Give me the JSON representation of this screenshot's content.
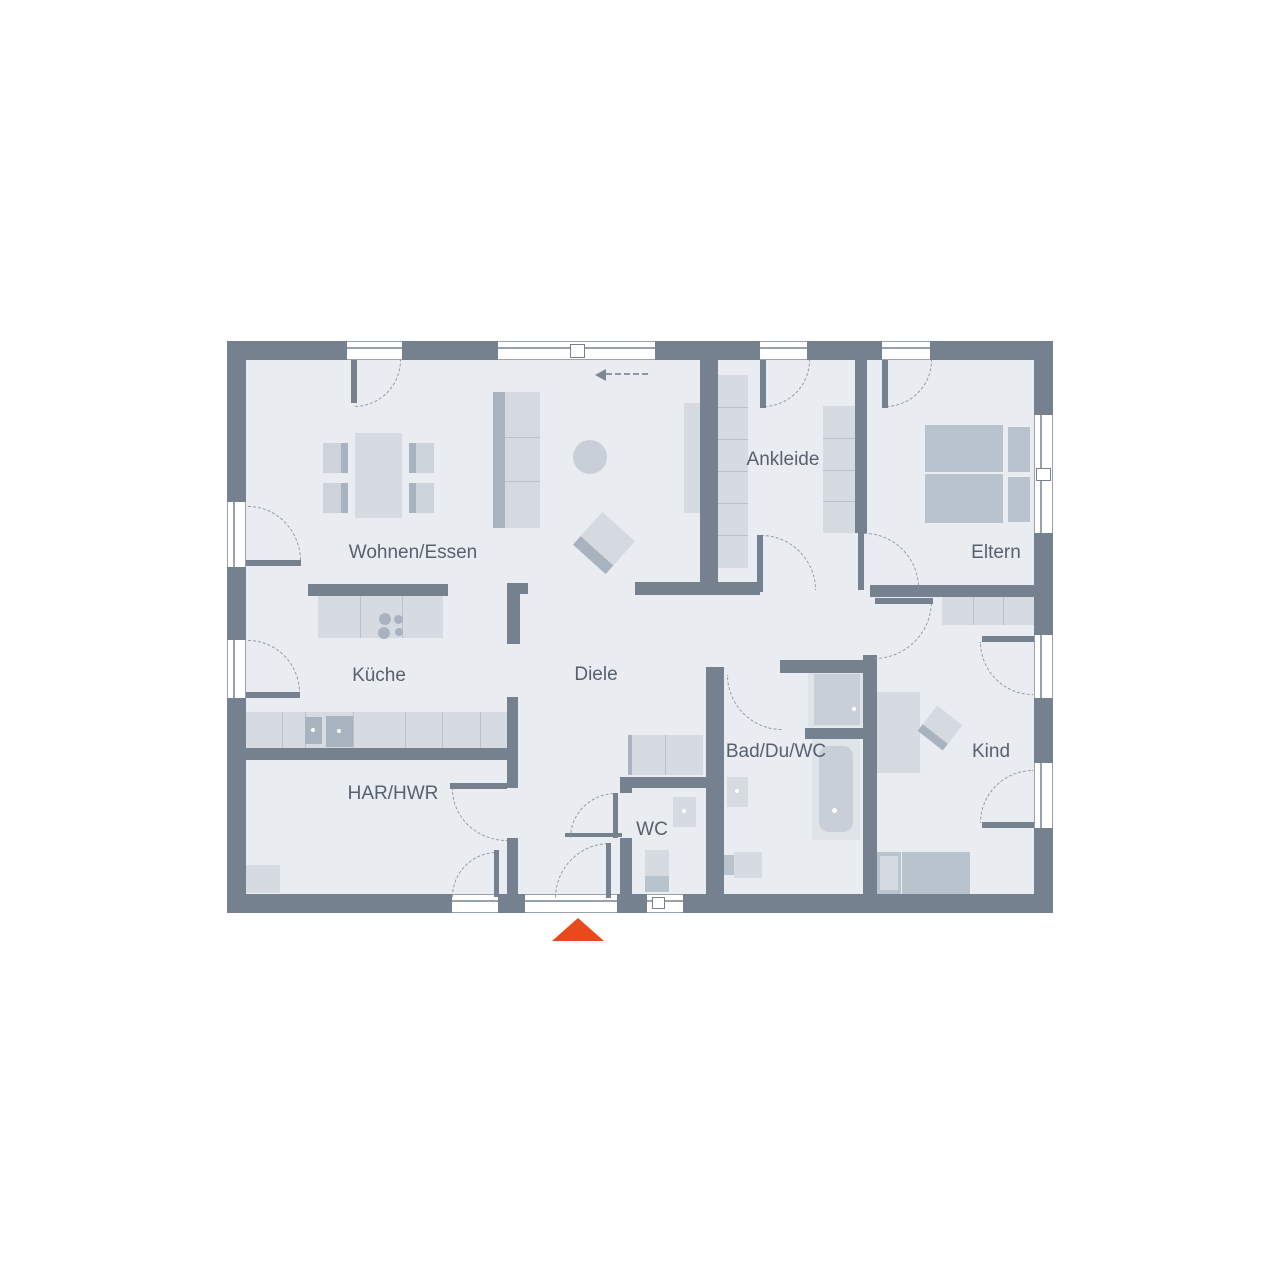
{
  "palette": {
    "wall": "#76818f",
    "floor": "#e9edf1",
    "furniture_light": "#d6dbe2",
    "furniture_mid": "#b9c3cd",
    "dash": "#8f99a5",
    "entry_marker_red": "#e8491d",
    "label_text": "#57616e"
  },
  "floorplan": {
    "floor": [
      246,
      360,
      788,
      534
    ],
    "labels": [
      {
        "t": "Wohnen/Essen",
        "x": 413,
        "y": 553
      },
      {
        "t": "Küche",
        "x": 379,
        "y": 676
      },
      {
        "t": "Diele",
        "x": 596,
        "y": 675
      },
      {
        "t": "HAR/HWR",
        "x": 393,
        "y": 794
      },
      {
        "t": "WC",
        "x": 652,
        "y": 830
      },
      {
        "t": "Bad/Du/WC",
        "x": 776,
        "y": 752
      },
      {
        "t": "Ankleide",
        "x": 783,
        "y": 460
      },
      {
        "t": "Eltern",
        "x": 996,
        "y": 553
      },
      {
        "t": "Kind",
        "x": 991,
        "y": 752
      }
    ],
    "walls": [
      [
        227,
        341,
        120,
        19
      ],
      [
        402,
        341,
        96,
        19
      ],
      [
        655,
        341,
        105,
        19
      ],
      [
        807,
        341,
        75,
        19
      ],
      [
        930,
        341,
        123,
        19
      ],
      [
        227,
        894,
        225,
        19
      ],
      [
        498,
        894,
        27,
        19
      ],
      [
        617,
        894,
        30,
        19
      ],
      [
        683,
        894,
        370,
        19
      ],
      [
        227,
        341,
        19,
        161
      ],
      [
        227,
        567,
        19,
        73
      ],
      [
        227,
        698,
        19,
        215
      ],
      [
        1034,
        341,
        19,
        74
      ],
      [
        1034,
        533,
        19,
        102
      ],
      [
        1034,
        698,
        19,
        65
      ],
      [
        1034,
        828,
        19,
        85
      ],
      [
        700,
        360,
        18,
        235
      ],
      [
        635,
        582,
        125,
        13
      ],
      [
        855,
        360,
        12,
        173
      ],
      [
        870,
        585,
        183,
        12
      ],
      [
        308,
        584,
        140,
        12
      ],
      [
        507,
        583,
        21,
        11
      ],
      [
        507,
        594,
        13,
        50
      ],
      [
        246,
        748,
        272,
        12
      ],
      [
        507,
        697,
        11,
        91
      ],
      [
        507,
        838,
        11,
        56
      ],
      [
        620,
        777,
        87,
        11
      ],
      [
        620,
        788,
        12,
        5
      ],
      [
        620,
        838,
        12,
        56
      ],
      [
        706,
        667,
        18,
        227
      ],
      [
        780,
        660,
        93,
        13
      ],
      [
        863,
        655,
        14,
        239
      ],
      [
        805,
        728,
        58,
        11
      ],
      [
        565,
        833,
        57,
        4
      ]
    ],
    "windows": [
      {
        "r": [
          347,
          341,
          55,
          19
        ],
        "o": "h"
      },
      {
        "r": [
          498,
          341,
          157,
          19
        ],
        "o": "h"
      },
      {
        "r": [
          760,
          341,
          47,
          19
        ],
        "o": "h"
      },
      {
        "r": [
          882,
          341,
          48,
          19
        ],
        "o": "h"
      },
      {
        "r": [
          452,
          894,
          46,
          19
        ],
        "o": "h"
      },
      {
        "r": [
          525,
          894,
          92,
          19
        ],
        "o": "h"
      },
      {
        "r": [
          647,
          894,
          36,
          19
        ],
        "o": "h"
      },
      {
        "r": [
          227,
          502,
          19,
          65
        ],
        "o": "v"
      },
      {
        "r": [
          227,
          640,
          19,
          58
        ],
        "o": "v"
      },
      {
        "r": [
          1034,
          415,
          19,
          118
        ],
        "o": "v"
      },
      {
        "r": [
          1034,
          635,
          19,
          63
        ],
        "o": "v"
      },
      {
        "r": [
          1034,
          763,
          19,
          65
        ],
        "o": "v"
      }
    ],
    "symbols": [
      {
        "r": [
          570,
          344,
          15,
          14
        ]
      },
      {
        "r": [
          652,
          897,
          13,
          12
        ]
      },
      {
        "r": [
          1036,
          468,
          15,
          13
        ]
      }
    ],
    "doors": [
      {
        "arc": [
          248,
          506,
          53,
          55
        ],
        "c": "tr",
        "leaf": [
          246,
          560,
          55,
          6
        ]
      },
      {
        "arc": [
          248,
          640,
          52,
          53
        ],
        "c": "tr",
        "leaf": [
          246,
          692,
          54,
          6
        ]
      },
      {
        "arc": [
          354,
          360,
          47,
          47
        ],
        "c": "br",
        "leaf": [
          351,
          360,
          6,
          43
        ]
      },
      {
        "arc": [
          763,
          360,
          47,
          47
        ],
        "c": "br",
        "leaf": [
          760,
          360,
          6,
          48
        ]
      },
      {
        "arc": [
          885,
          360,
          47,
          47
        ],
        "c": "br",
        "leaf": [
          882,
          360,
          6,
          48
        ]
      },
      {
        "arc": [
          761,
          535,
          55,
          55
        ],
        "c": "tr",
        "leaf": [
          757,
          535,
          6,
          57
        ]
      },
      {
        "arc": [
          864,
          533,
          55,
          55
        ],
        "c": "tr",
        "leaf": [
          858,
          533,
          6,
          57
        ]
      },
      {
        "arc": [
          874,
          601,
          58,
          58
        ],
        "c": "br",
        "leaf": [
          875,
          598,
          58,
          6
        ]
      },
      {
        "arc": [
          980,
          642,
          53,
          53
        ],
        "c": "bl",
        "leaf": [
          982,
          636,
          52,
          6
        ]
      },
      {
        "arc": [
          980,
          770,
          53,
          53
        ],
        "c": "tl",
        "leaf": [
          982,
          822,
          52,
          6
        ]
      },
      {
        "arc": [
          727,
          675,
          55,
          55
        ],
        "c": "bl"
      },
      {
        "arc": [
          452,
          789,
          55,
          52
        ],
        "c": "bl",
        "leaf": [
          450,
          783,
          57,
          6
        ]
      },
      {
        "arc": [
          452,
          852,
          45,
          45
        ],
        "c": "tl",
        "leaf": [
          494,
          850,
          5,
          47
        ]
      },
      {
        "arc": [
          555,
          843,
          55,
          55
        ],
        "c": "tl",
        "leaf": [
          606,
          843,
          5,
          55
        ]
      },
      {
        "arc": [
          570,
          793,
          46,
          45
        ],
        "c": "tl",
        "leaf": [
          613,
          793,
          5,
          45
        ]
      }
    ],
    "items": [
      {
        "n": "dining-table",
        "r": [
          355,
          433,
          47,
          85
        ],
        "cls": "f-light"
      },
      {
        "n": "dining-chair",
        "r": [
          323,
          443,
          25,
          30
        ],
        "cls": "ch-l"
      },
      {
        "n": "dining-chair",
        "r": [
          323,
          483,
          25,
          30
        ],
        "cls": "ch-l"
      },
      {
        "n": "dining-chair",
        "r": [
          409,
          443,
          25,
          30
        ],
        "cls": "ch-r"
      },
      {
        "n": "dining-chair",
        "r": [
          409,
          483,
          25,
          30
        ],
        "cls": "ch-r"
      },
      {
        "n": "sofa",
        "r": [
          493,
          392,
          47,
          136
        ],
        "cls": "sofa"
      },
      {
        "n": "divider",
        "r": [
          505,
          437,
          35,
          1
        ],
        "cls": "f-line"
      },
      {
        "n": "divider",
        "r": [
          505,
          481,
          35,
          1
        ],
        "cls": "f-line"
      },
      {
        "n": "tv-shelf",
        "r": [
          684,
          403,
          16,
          110
        ],
        "cls": "f-light"
      },
      {
        "n": "side-table",
        "r": [
          573,
          440,
          34,
          34
        ],
        "cls": "f-mid",
        "rad": 50
      },
      {
        "n": "armchair",
        "r": [
          582,
          521,
          44,
          44
        ],
        "cls": "armch",
        "rot": 42
      },
      {
        "n": "kitchen-island",
        "r": [
          318,
          596,
          125,
          42
        ],
        "cls": "f-light"
      },
      {
        "n": "divider",
        "r": [
          360,
          596,
          1,
          42
        ],
        "cls": "f-line"
      },
      {
        "n": "divider",
        "r": [
          402,
          596,
          1,
          42
        ],
        "cls": "f-line"
      },
      {
        "n": "cooktop-burner",
        "r": [
          379,
          613,
          12,
          12
        ],
        "cls": "f-dark",
        "rad": 50
      },
      {
        "n": "cooktop-burner",
        "r": [
          378,
          627,
          12,
          12
        ],
        "cls": "f-dark",
        "rad": 50
      },
      {
        "n": "cooktop-burner",
        "r": [
          394,
          615,
          9,
          9
        ],
        "cls": "f-dark",
        "rad": 50
      },
      {
        "n": "cooktop-burner",
        "r": [
          395,
          628,
          8,
          8
        ],
        "cls": "f-dark",
        "rad": 50
      },
      {
        "n": "kitchen-counter",
        "r": [
          246,
          712,
          261,
          36
        ],
        "cls": "f-light"
      },
      {
        "n": "divider",
        "r": [
          282,
          712,
          1,
          36
        ],
        "cls": "f-line"
      },
      {
        "n": "divider",
        "r": [
          305,
          712,
          1,
          36
        ],
        "cls": "f-line"
      },
      {
        "n": "divider",
        "r": [
          353,
          712,
          1,
          36
        ],
        "cls": "f-line"
      },
      {
        "n": "divider",
        "r": [
          405,
          712,
          1,
          36
        ],
        "cls": "f-line"
      },
      {
        "n": "divider",
        "r": [
          442,
          712,
          1,
          36
        ],
        "cls": "f-line"
      },
      {
        "n": "divider",
        "r": [
          480,
          712,
          1,
          36
        ],
        "cls": "f-line"
      },
      {
        "n": "kitchen-sink",
        "r": [
          305,
          717,
          17,
          27
        ],
        "cls": "f-dark"
      },
      {
        "n": "kitchen-appliance",
        "r": [
          326,
          716,
          27,
          31
        ],
        "cls": "f-dark"
      },
      {
        "n": "dot",
        "r": [
          311,
          728,
          4,
          4
        ],
        "cls": "f-dot"
      },
      {
        "n": "dot",
        "r": [
          337,
          729,
          4,
          4
        ],
        "cls": "f-dot"
      },
      {
        "n": "washing-machine",
        "r": [
          246,
          865,
          34,
          28
        ],
        "cls": "f-light"
      },
      {
        "n": "sideboard",
        "r": [
          628,
          735,
          75,
          40
        ],
        "cls": "f-light"
      },
      {
        "n": "sideboard-edge",
        "r": [
          628,
          735,
          4,
          40
        ],
        "cls": "f-strip"
      },
      {
        "n": "divider",
        "r": [
          665,
          735,
          1,
          40
        ],
        "cls": "f-line"
      },
      {
        "n": "wc-sink",
        "r": [
          673,
          797,
          23,
          30
        ],
        "cls": "f-light"
      },
      {
        "n": "dot",
        "r": [
          682,
          809,
          4,
          4
        ],
        "cls": "f-dot"
      },
      {
        "n": "wc-toilet",
        "r": [
          645,
          850,
          24,
          26
        ],
        "cls": "f-light"
      },
      {
        "n": "wc-toilet-tank",
        "r": [
          645,
          876,
          24,
          16
        ],
        "cls": "f-mid2"
      },
      {
        "n": "shower",
        "r": [
          808,
          672,
          58,
          55
        ],
        "cls": "f-xlight"
      },
      {
        "n": "shower-tray",
        "r": [
          814,
          674,
          46,
          51
        ],
        "cls": "f-mid"
      },
      {
        "n": "dot",
        "r": [
          852,
          707,
          4,
          4
        ],
        "cls": "f-dot"
      },
      {
        "n": "bathtub",
        "r": [
          812,
          739,
          48,
          101
        ],
        "cls": "f-xlight"
      },
      {
        "n": "bathtub-basin",
        "r": [
          819,
          746,
          34,
          86
        ],
        "cls": "f-mid",
        "rad": 10
      },
      {
        "n": "dot",
        "r": [
          832,
          808,
          5,
          5
        ],
        "cls": "f-dot"
      },
      {
        "n": "bath-sink",
        "r": [
          727,
          777,
          21,
          30
        ],
        "cls": "f-light"
      },
      {
        "n": "dot",
        "r": [
          735,
          789,
          4,
          4
        ],
        "cls": "f-dot"
      },
      {
        "n": "bath-toilet",
        "r": [
          734,
          852,
          28,
          26
        ],
        "cls": "f-light"
      },
      {
        "n": "bath-toilet-tank",
        "r": [
          724,
          855,
          10,
          20
        ],
        "cls": "f-mid2"
      },
      {
        "n": "wardrobe",
        "r": [
          718,
          375,
          30,
          193
        ],
        "cls": "f-light"
      },
      {
        "n": "divider",
        "r": [
          718,
          407,
          30,
          1
        ],
        "cls": "f-line"
      },
      {
        "n": "divider",
        "r": [
          718,
          439,
          30,
          1
        ],
        "cls": "f-line"
      },
      {
        "n": "divider",
        "r": [
          718,
          471,
          30,
          1
        ],
        "cls": "f-line"
      },
      {
        "n": "divider",
        "r": [
          718,
          503,
          30,
          1
        ],
        "cls": "f-line"
      },
      {
        "n": "divider",
        "r": [
          718,
          535,
          30,
          1
        ],
        "cls": "f-line"
      },
      {
        "n": "wardrobe",
        "r": [
          823,
          406,
          32,
          127
        ],
        "cls": "f-light"
      },
      {
        "n": "divider",
        "r": [
          823,
          438,
          32,
          1
        ],
        "cls": "f-line"
      },
      {
        "n": "divider",
        "r": [
          823,
          470,
          32,
          1
        ],
        "cls": "f-line"
      },
      {
        "n": "divider",
        "r": [
          823,
          501,
          32,
          1
        ],
        "cls": "f-line"
      },
      {
        "n": "bed-mattress",
        "r": [
          925,
          425,
          78,
          47
        ],
        "cls": "f-mid2"
      },
      {
        "n": "bed-mattress",
        "r": [
          925,
          474,
          78,
          49
        ],
        "cls": "f-mid2"
      },
      {
        "n": "nightstand",
        "r": [
          1008,
          427,
          22,
          45
        ],
        "cls": "f-mid2"
      },
      {
        "n": "nightstand",
        "r": [
          1008,
          477,
          22,
          45
        ],
        "cls": "f-mid2"
      },
      {
        "n": "wardrobe",
        "r": [
          942,
          593,
          92,
          32
        ],
        "cls": "f-light"
      },
      {
        "n": "divider",
        "r": [
          973,
          593,
          1,
          32
        ],
        "cls": "f-line"
      },
      {
        "n": "divider",
        "r": [
          1003,
          593,
          1,
          32
        ],
        "cls": "f-line"
      },
      {
        "n": "desk",
        "r": [
          875,
          692,
          45,
          81
        ],
        "cls": "f-light"
      },
      {
        "n": "desk-chair",
        "r": [
          924,
          712,
          32,
          32
        ],
        "cls": "armch",
        "rot": 38
      },
      {
        "n": "bed",
        "r": [
          877,
          852,
          93,
          42
        ],
        "cls": "f-mid2"
      },
      {
        "n": "divider",
        "r": [
          901,
          852,
          1,
          42
        ],
        "cls": "f-linew"
      },
      {
        "n": "bed-pillow",
        "r": [
          880,
          856,
          18,
          34
        ],
        "cls": "f-light"
      }
    ],
    "slide_arrow": {
      "head_x": 595,
      "head_y": 369,
      "line_x": 606,
      "line_y": 373,
      "line_w": 42
    },
    "entry_marker": {
      "x": 552,
      "y": 918,
      "height": 23,
      "color": "#e8491d"
    }
  }
}
